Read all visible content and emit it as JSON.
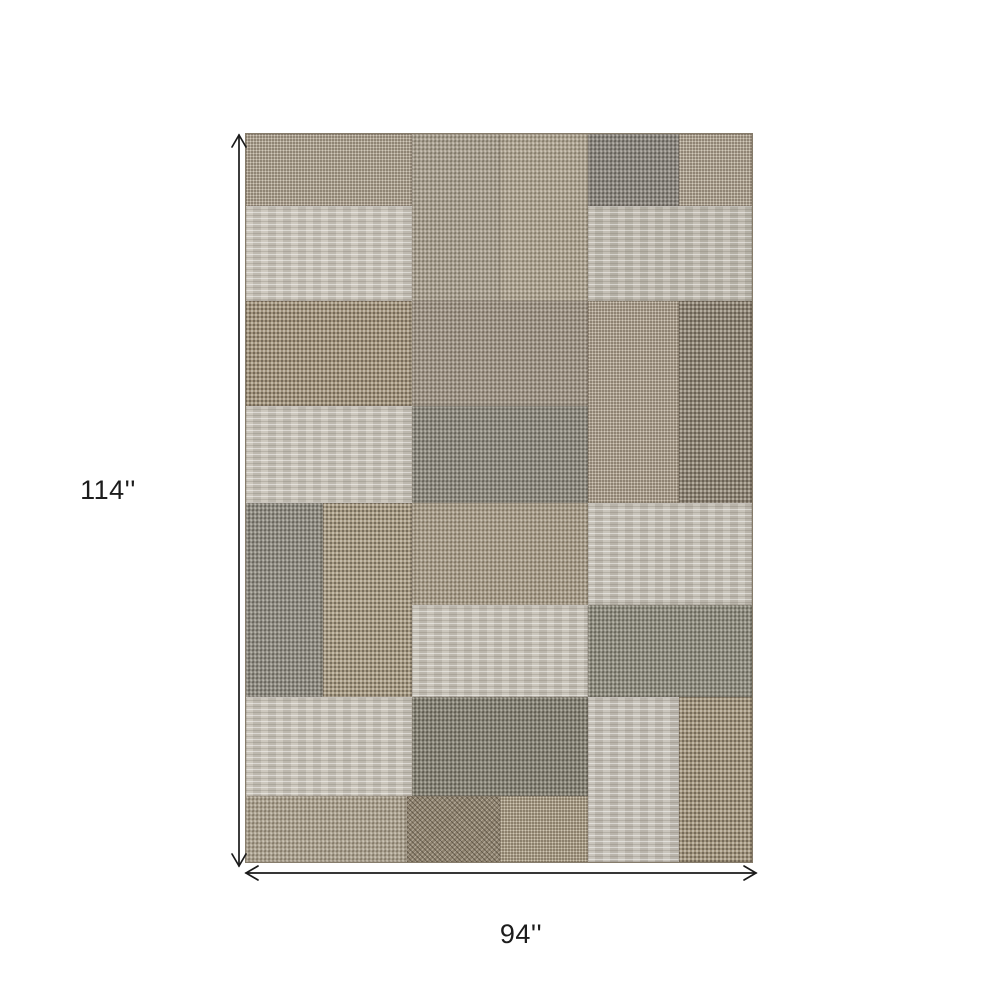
{
  "page": {
    "background": "#ffffff"
  },
  "dimensions": {
    "height_label": "114''",
    "width_label": "94''",
    "arrow_color": "#1a1a1a",
    "label_color": "#1c1c1c"
  },
  "rug": {
    "description": "patchwork flatweave rug in beige, taupe and gray rectangles",
    "base_color": "#a79b89",
    "edge_color": "#867c6b",
    "patches": [
      {
        "x": 0,
        "y": 0,
        "w": 32.9,
        "h": 9.9,
        "color": "#a79c8b",
        "texture": "speckle"
      },
      {
        "x": 32.9,
        "y": 0,
        "w": 17.3,
        "h": 22.9,
        "color": "#a49a86",
        "texture": "basket"
      },
      {
        "x": 50.2,
        "y": 0,
        "w": 17.3,
        "h": 22.9,
        "color": "#aca089",
        "texture": "basket"
      },
      {
        "x": 67.5,
        "y": 0,
        "w": 18.1,
        "h": 9.9,
        "color": "#8b857c",
        "texture": "dark-basket"
      },
      {
        "x": 85.6,
        "y": 0,
        "w": 14.4,
        "h": 9.9,
        "color": "#a89d8c",
        "texture": "speckle"
      },
      {
        "x": 0,
        "y": 9.9,
        "w": 32.9,
        "h": 13.0,
        "color": "#c8c3b8",
        "texture": "heather"
      },
      {
        "x": 67.5,
        "y": 9.9,
        "w": 32.5,
        "h": 13.0,
        "color": "#bdb8ad",
        "texture": "heather"
      },
      {
        "x": 0,
        "y": 22.9,
        "w": 32.9,
        "h": 14.4,
        "color": "#a3967f",
        "texture": "dot"
      },
      {
        "x": 32.9,
        "y": 22.9,
        "w": 34.6,
        "h": 14.4,
        "color": "#998c7a",
        "texture": "basket"
      },
      {
        "x": 67.5,
        "y": 22.9,
        "w": 18.1,
        "h": 27.8,
        "color": "#a69a89",
        "texture": "speckle"
      },
      {
        "x": 85.6,
        "y": 22.9,
        "w": 14.4,
        "h": 27.8,
        "color": "#8e8576",
        "texture": "dot"
      },
      {
        "x": 0,
        "y": 37.3,
        "w": 32.9,
        "h": 13.4,
        "color": "#c7c2b7",
        "texture": "heather"
      },
      {
        "x": 32.9,
        "y": 37.3,
        "w": 34.6,
        "h": 13.4,
        "color": "#8d897c",
        "texture": "dark-basket"
      },
      {
        "x": 0,
        "y": 50.7,
        "w": 15.2,
        "h": 26.7,
        "color": "#8f8c80",
        "texture": "dark-basket"
      },
      {
        "x": 15.2,
        "y": 50.7,
        "w": 17.7,
        "h": 26.7,
        "color": "#a89c86",
        "texture": "dot"
      },
      {
        "x": 32.9,
        "y": 50.7,
        "w": 34.6,
        "h": 14.0,
        "color": "#a4977f",
        "texture": "basket"
      },
      {
        "x": 67.5,
        "y": 50.7,
        "w": 32.5,
        "h": 14.0,
        "color": "#c3beb3",
        "texture": "heather"
      },
      {
        "x": 32.9,
        "y": 64.7,
        "w": 34.6,
        "h": 12.7,
        "color": "#c5c0b5",
        "texture": "heather"
      },
      {
        "x": 67.5,
        "y": 64.7,
        "w": 32.5,
        "h": 12.7,
        "color": "#908d7d",
        "texture": "dark-basket"
      },
      {
        "x": 0,
        "y": 77.4,
        "w": 32.9,
        "h": 13.6,
        "color": "#c7c2b7",
        "texture": "heather"
      },
      {
        "x": 32.9,
        "y": 77.4,
        "w": 34.6,
        "h": 13.6,
        "color": "#84806f",
        "texture": "dark-basket"
      },
      {
        "x": 67.5,
        "y": 77.4,
        "w": 18.1,
        "h": 22.6,
        "color": "#c3beb4",
        "texture": "heather"
      },
      {
        "x": 85.6,
        "y": 77.4,
        "w": 14.4,
        "h": 22.6,
        "color": "#a2967f",
        "texture": "dot"
      },
      {
        "x": 0,
        "y": 91.0,
        "w": 31.9,
        "h": 9.0,
        "color": "#a89c86",
        "texture": "basket"
      },
      {
        "x": 31.9,
        "y": 91.0,
        "w": 18.3,
        "h": 9.0,
        "color": "#8f8370",
        "texture": "cross"
      },
      {
        "x": 50.2,
        "y": 91.0,
        "w": 17.3,
        "h": 9.0,
        "color": "#a2967f",
        "texture": "speckle"
      }
    ]
  }
}
